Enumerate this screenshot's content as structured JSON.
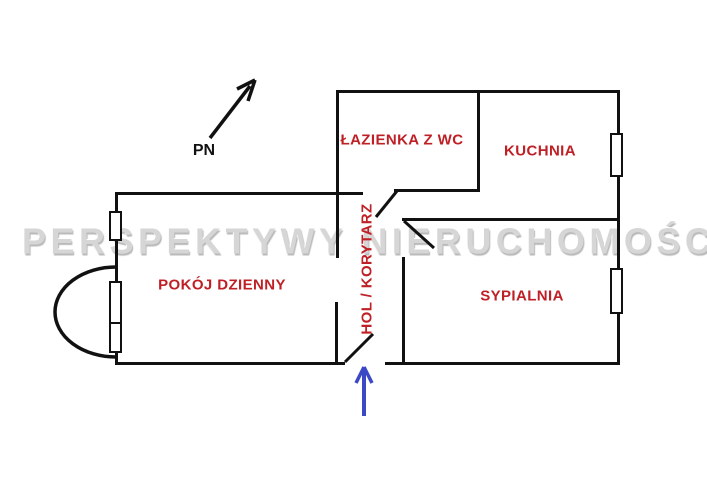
{
  "watermark": {
    "text": "PERSPEKTYWY NIERUCHOMOŚCI"
  },
  "compass": {
    "label": "PN",
    "meaning": "north-arrow"
  },
  "rooms": {
    "bathroom": {
      "label": "ŁAZIENKA Z WC"
    },
    "kitchen": {
      "label": "KUCHNIA"
    },
    "living_room": {
      "label": "POKÓJ DZIENNY"
    },
    "bedroom": {
      "label": "SYPIALNIA"
    },
    "hall": {
      "label": "HOL / KORYTARZ"
    }
  },
  "entrance": {
    "indicator": "blue-arrow-up"
  },
  "colors": {
    "wall": "#111111",
    "room_label": "#bf2025",
    "compass": "#111111",
    "entrance_arrow": "#3b49c6",
    "watermark": "#d6d6d6",
    "background": "#ffffff"
  }
}
